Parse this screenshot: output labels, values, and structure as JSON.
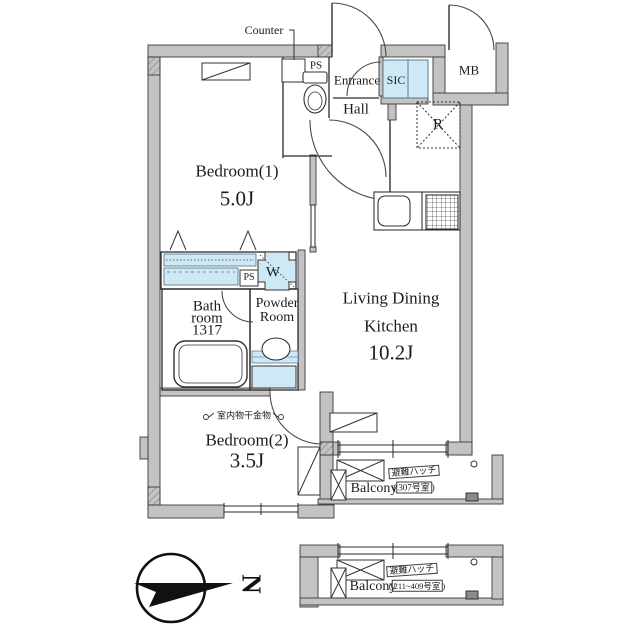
{
  "labels": {
    "counter": "Counter",
    "ps_top": "PS",
    "entrance": "Entrance",
    "hall": "Hall",
    "sic": "SIC",
    "mb": "MB",
    "fridge": "R",
    "bedroom1_name": "Bedroom(1)",
    "bedroom1_size": "5.0J",
    "ldk_line1": "Living Dining",
    "ldk_line2": "Kitchen",
    "ldk_size": "10.2J",
    "ps_mid": "PS",
    "washer": "W",
    "bath_line1": "Bath",
    "bath_line2": "room",
    "bath_line3": "1317",
    "powder_line1": "Powder",
    "powder_line2": "Room",
    "drying": "室内物干金物",
    "bedroom2_name": "Bedroom(2)",
    "bedroom2_size": "3.5J",
    "compass_north": "N"
  },
  "balcony_upper": {
    "name": "Balcony",
    "hatch": "避難ハッチ",
    "paren_open": "(",
    "room_no": "307号室",
    "paren_close": ")"
  },
  "balcony_lower": {
    "name": "Balcony",
    "hatch": "避難ハッチ",
    "paren_open": "(",
    "room_no": "211~409号室",
    "paren_close": ")"
  },
  "colors": {
    "fixture_blue": "#cfe8f5",
    "wall_gray": "#c3c3c3",
    "line_dark": "#333333"
  }
}
